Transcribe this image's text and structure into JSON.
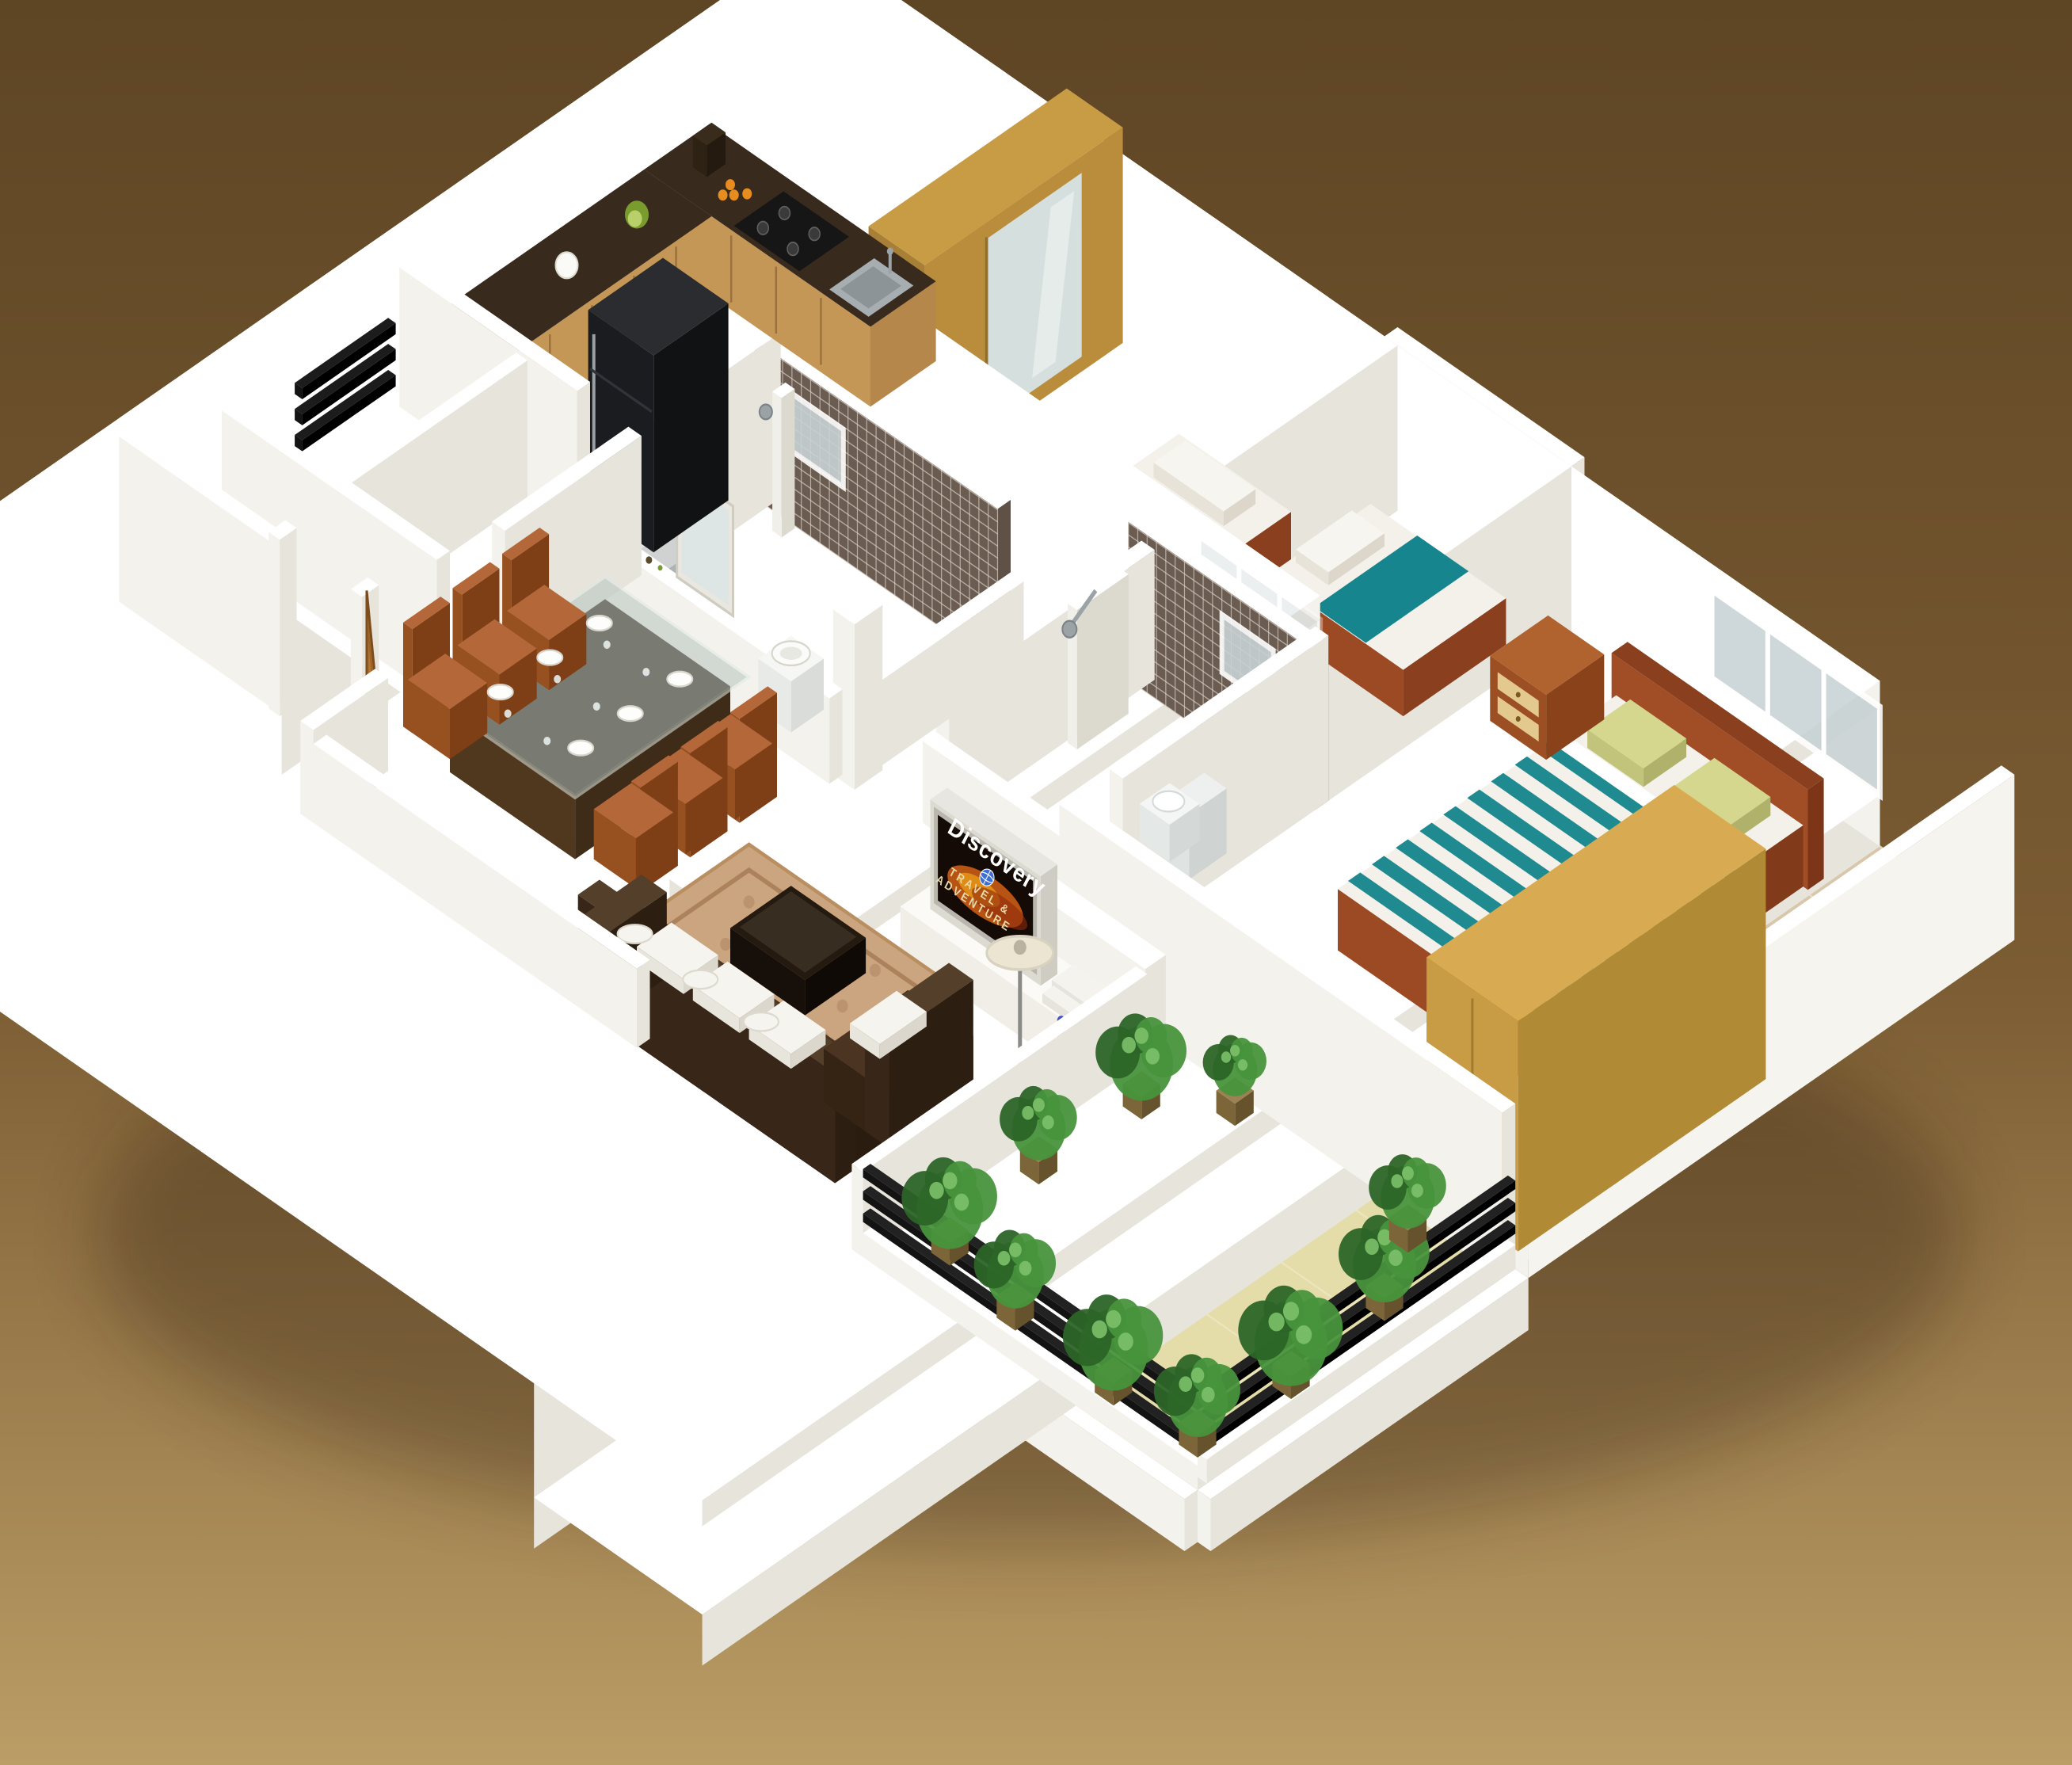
{
  "tv": {
    "channel": "Discovery",
    "caption_1": "TRAVEL &",
    "caption_2": "ADVENTURE"
  },
  "palette": {
    "bg_top": "#5e4524",
    "bg_mid": "#7b5c33",
    "bg_bottom": "#bb9d66",
    "wall_top": "#ffffff",
    "wall_light": "#f4f2ec",
    "wall_mid": "#e7e4dc",
    "wall_dark": "#d9d5cb",
    "floor_tile": "#d9c7ac",
    "floor_grout": "#efe4cd",
    "bath_floor": "#ded7ab",
    "utility_floor": "#efe7b8",
    "balcony_floor": "#e4dda9",
    "mosaic_dark": "#6b5c51",
    "mosaic_side": "#5f5146",
    "mosaic_grout": "#d8cfc5",
    "counter_top": "#382a1d",
    "cabinet_wood": "#c59757",
    "wardrobe_wood": "#c89b45",
    "wood_red": "#a14e27",
    "door_wood": "#b5742f",
    "teal": "#17858d",
    "bed_white": "#f3f1ea",
    "pillow_green": "#d5d78f",
    "sofa_dark": "#4b3522",
    "cushion_white": "#f6f4ee",
    "rug_light": "#cba57f",
    "rug_dark": "#a97e5a",
    "fridge_dark": "#191a1d",
    "steel": "#9ba3a7",
    "glass": "#c8d2d4",
    "tv_dark": "#140a06",
    "flame_orange": "#e06616",
    "flame_yellow": "#f0a21a",
    "plant_green": "#48933c",
    "plant_deep": "#2c6527",
    "pot_tan": "#9a8252",
    "rail_black": "#131313",
    "lamp_cream": "#ece5d2",
    "flower_blue": "#4752c4"
  }
}
